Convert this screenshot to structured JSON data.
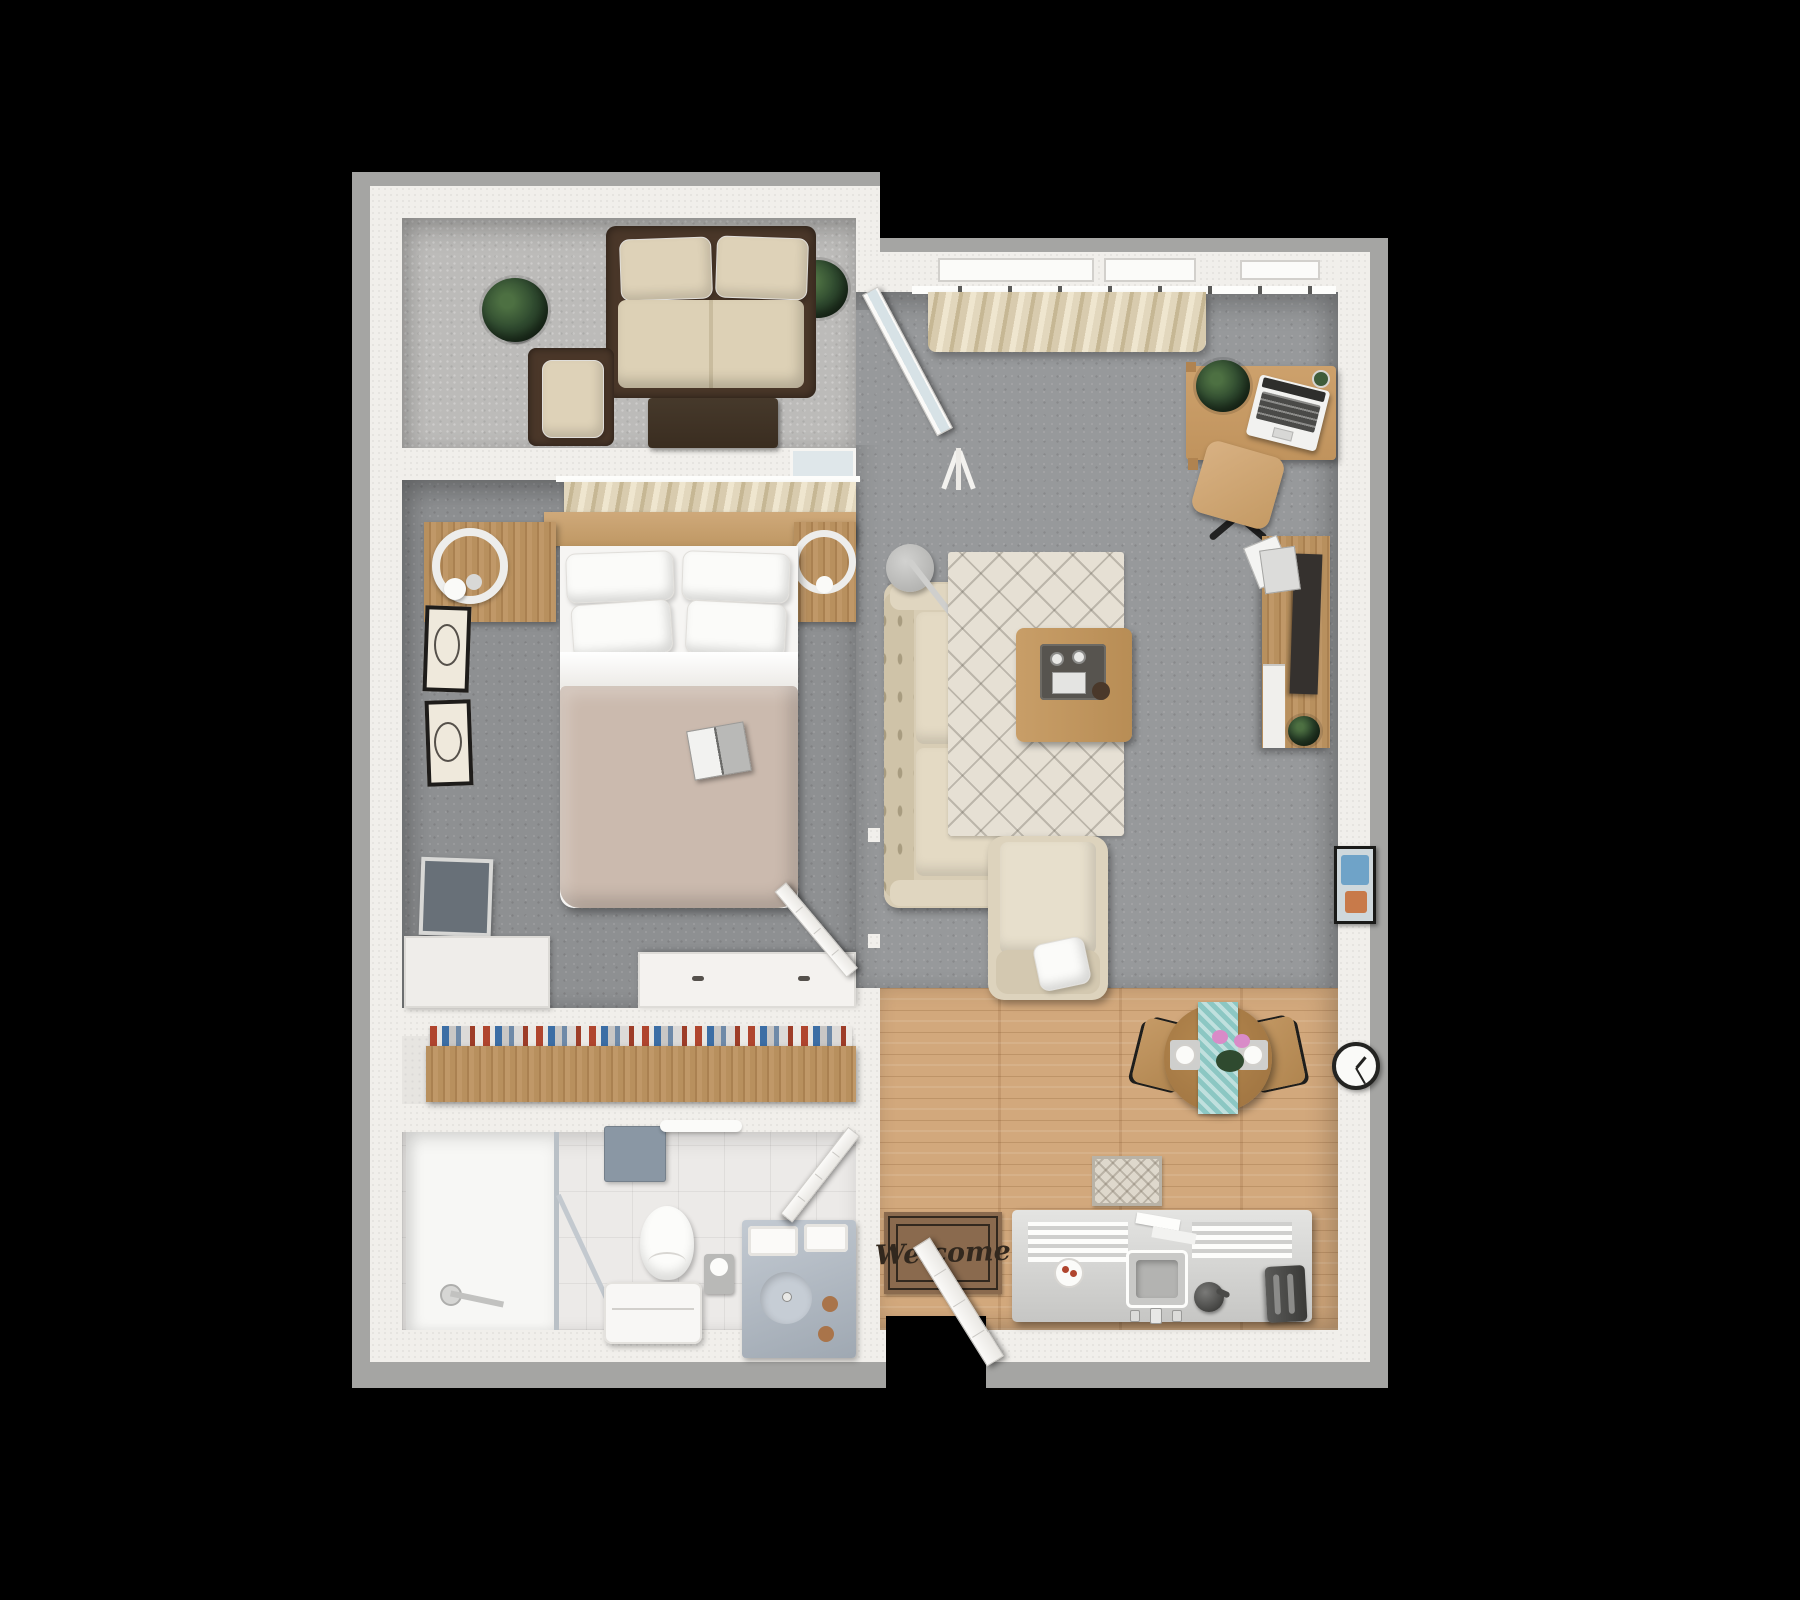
{
  "scene": {
    "type": "3D top-down apartment floor plan render",
    "background_color": "#000000"
  },
  "doormat": {
    "text": "Welcome"
  },
  "palette": {
    "wall": "#f1efeb",
    "wall_shadow": "#a5a5a3",
    "patio_concrete": "#bcbbb9",
    "bedroom_carpet": "#8e9092",
    "living_carpet": "#97999b",
    "wood_floor": "#d2a87c",
    "bathroom_tile": "#eceae8",
    "wood_furniture": "#c79b66",
    "wicker_brown": "#4a3729",
    "sofa_cream": "#ded3bc",
    "blanket_taupe": "#cbbaae",
    "teal_runner": "#8cc7c3",
    "flower_pink": "#d98bc8",
    "towel_blue_gray": "#8a97a4"
  },
  "rooms": [
    {
      "name": "patio",
      "furniture": [
        "wicker loveseat with cream cushions",
        "wicker armchair",
        "dark wood coffee table",
        "potted plant corner",
        "potted plant right"
      ]
    },
    {
      "name": "bedroom",
      "furniture": [
        "double bed with taupe blanket",
        "wood headboard",
        "left nightstand with ring lamp",
        "right nightstand with ring lamp",
        "two wall art frames",
        "wall mounted tv",
        "white dresser",
        "window curtains",
        "open book on bed"
      ]
    },
    {
      "name": "hallway-closet",
      "furniture": [
        "wood shoe shelf with books"
      ]
    },
    {
      "name": "bathroom",
      "furniture": [
        "walk-in shower",
        "toilet",
        "white bench",
        "wall towel",
        "towel bar",
        "toilet paper holder",
        "double sink vanity",
        "bathroom door"
      ]
    },
    {
      "name": "living-room",
      "furniture": [
        "cream sofa",
        "arc floor lamp",
        "diamond pattern rug",
        "coffee table with tray",
        "cream armchair with pillow",
        "desk with laptop and plant",
        "desk chair",
        "tv media console",
        "window curtains",
        "wall art frame",
        "wall clock"
      ]
    },
    {
      "name": "kitchen-dining",
      "furniture": [
        "round dining table with teal runner",
        "two dining chairs",
        "kitchen counter with sink",
        "toaster",
        "kettle",
        "plate with food",
        "runner rug",
        "welcome doormat",
        "entry door"
      ]
    }
  ]
}
